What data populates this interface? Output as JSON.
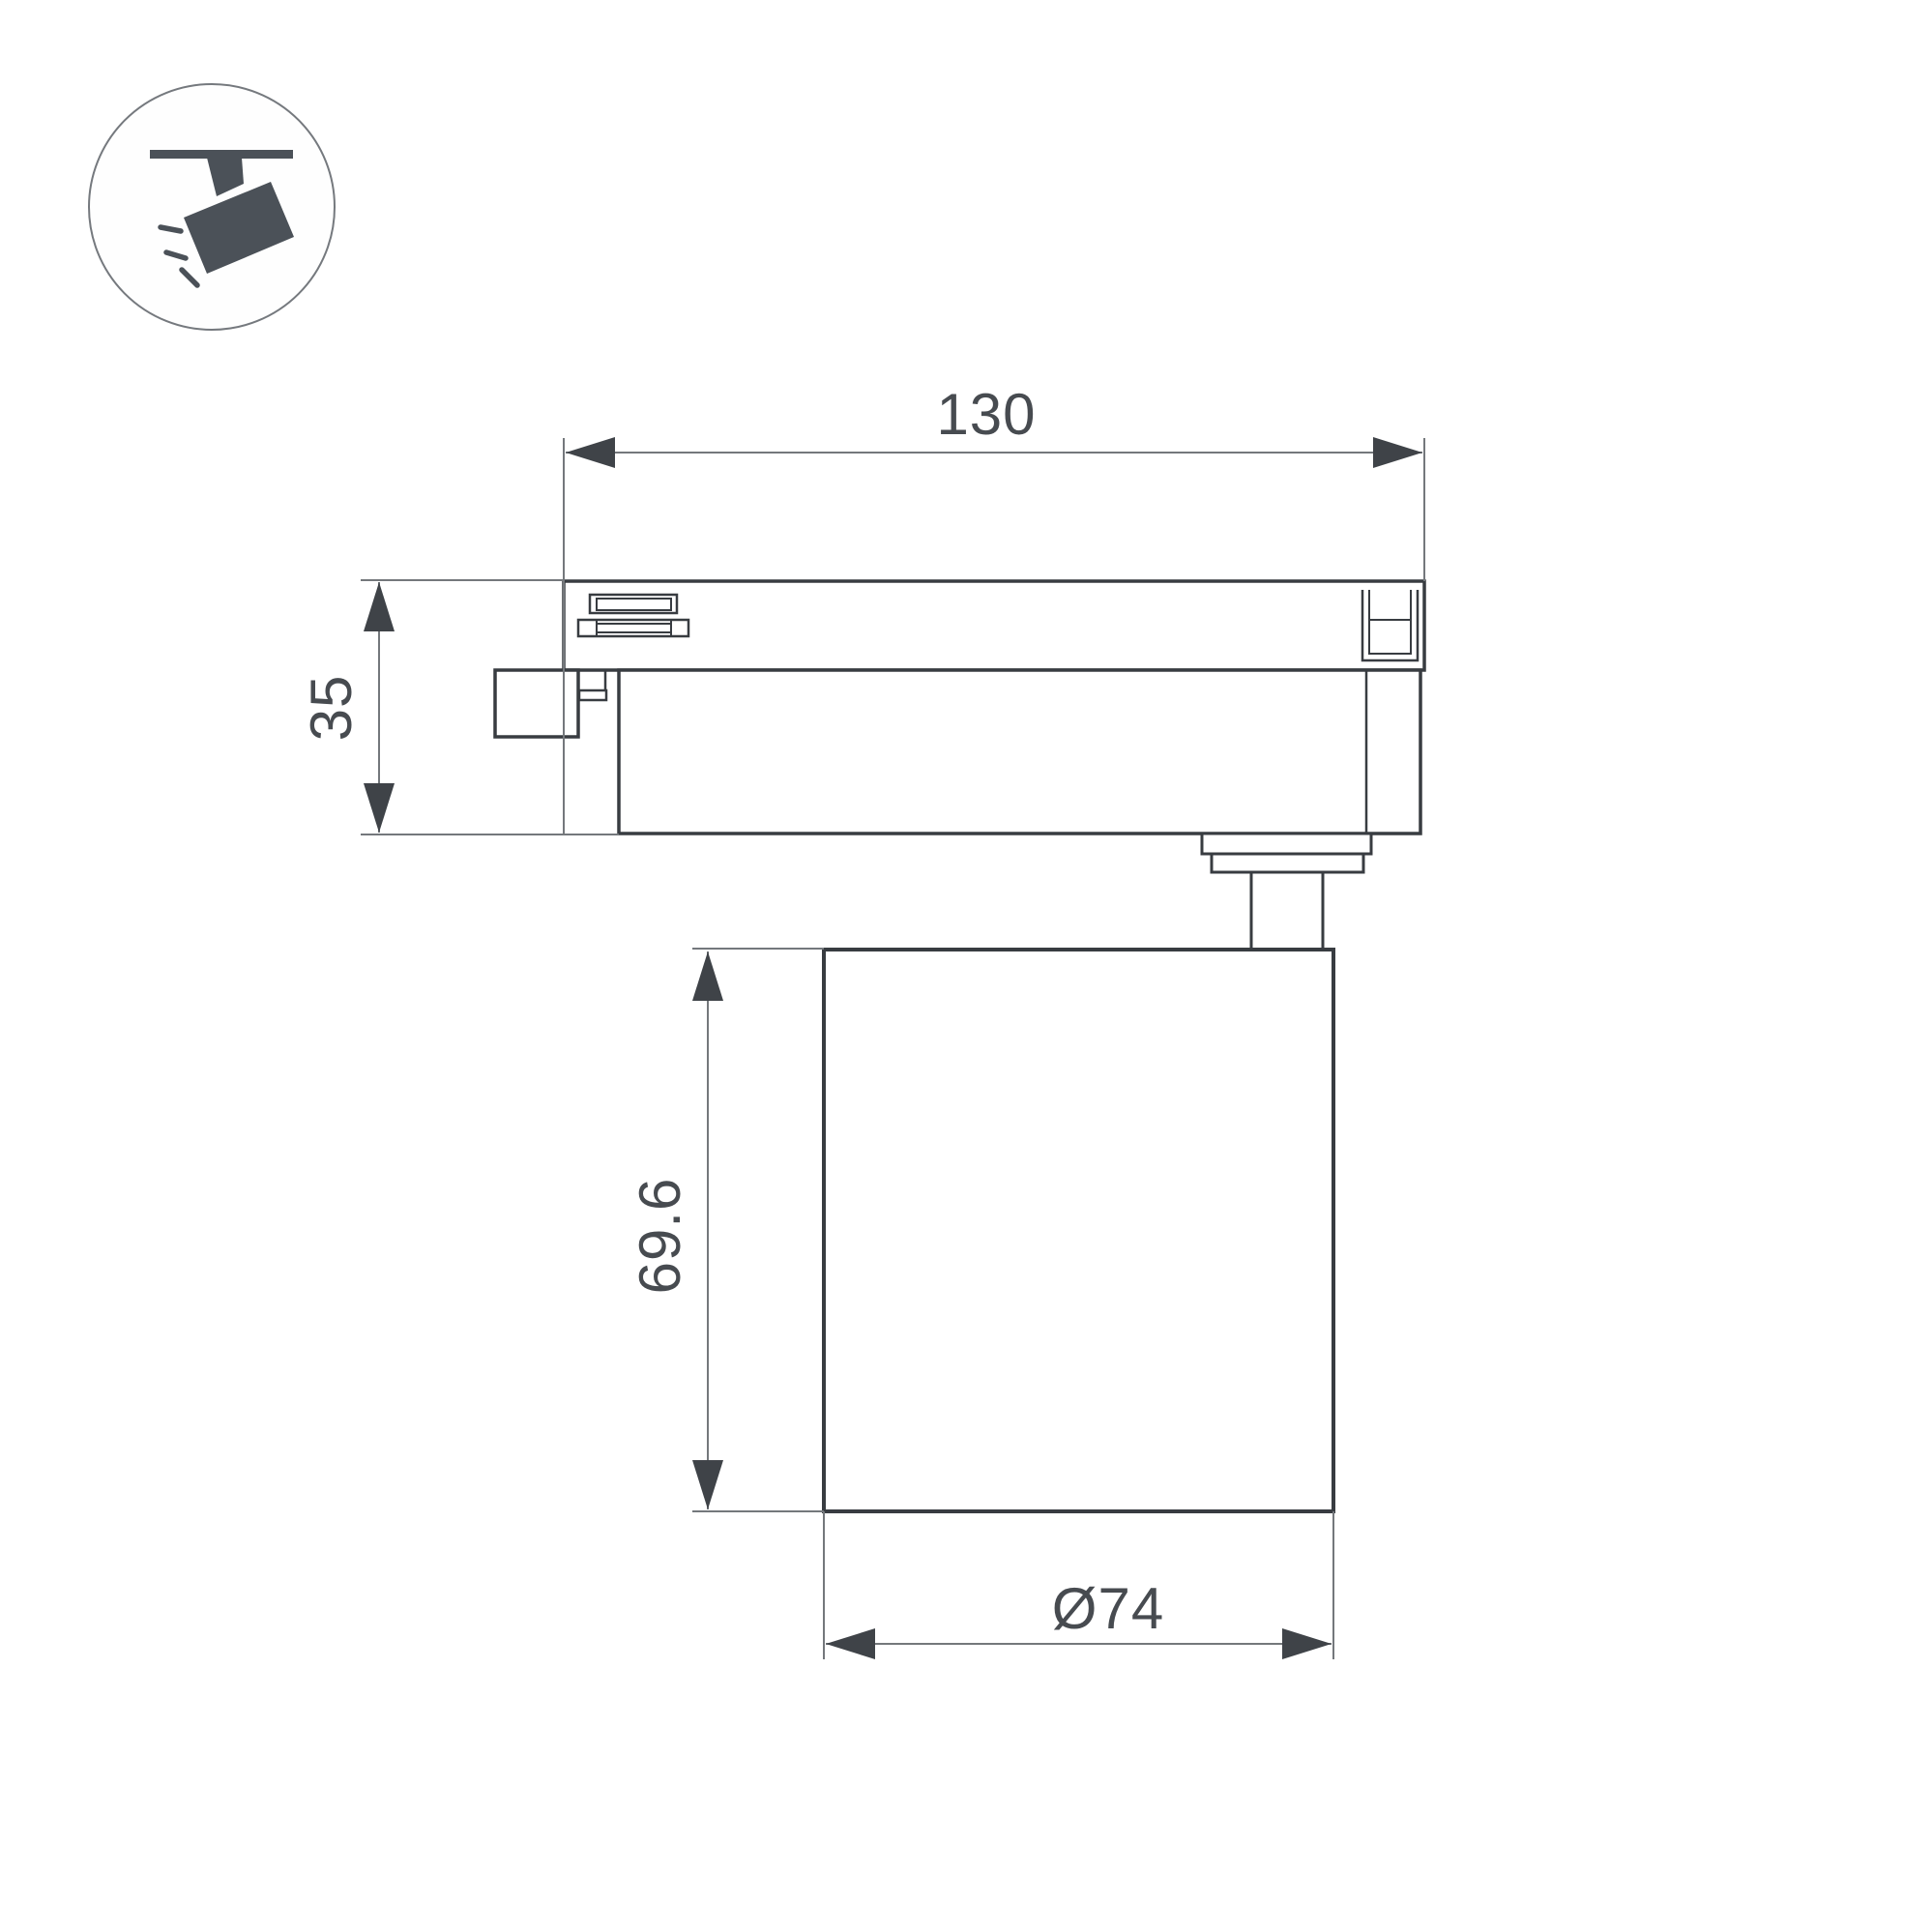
{
  "drawing": {
    "kind": "technical-dimension-drawing",
    "subject": "track-mounted spotlight luminaire, side view"
  },
  "icon": {
    "name": "track-spotlight-pictogram",
    "description": "ceiling track with tilted spotlight emitting light rays"
  },
  "dimensions": {
    "adapter_width": "130",
    "adapter_height": "35",
    "body_height": "69.6",
    "body_diameter": "Ø74"
  },
  "colors": {
    "background": "#ffffff",
    "outline": "#383c41",
    "dimension_line": "#74787c",
    "arrow": "#3f4348",
    "text": "#474b50",
    "icon": "#4b5158",
    "icon_circle": "#75797e"
  }
}
